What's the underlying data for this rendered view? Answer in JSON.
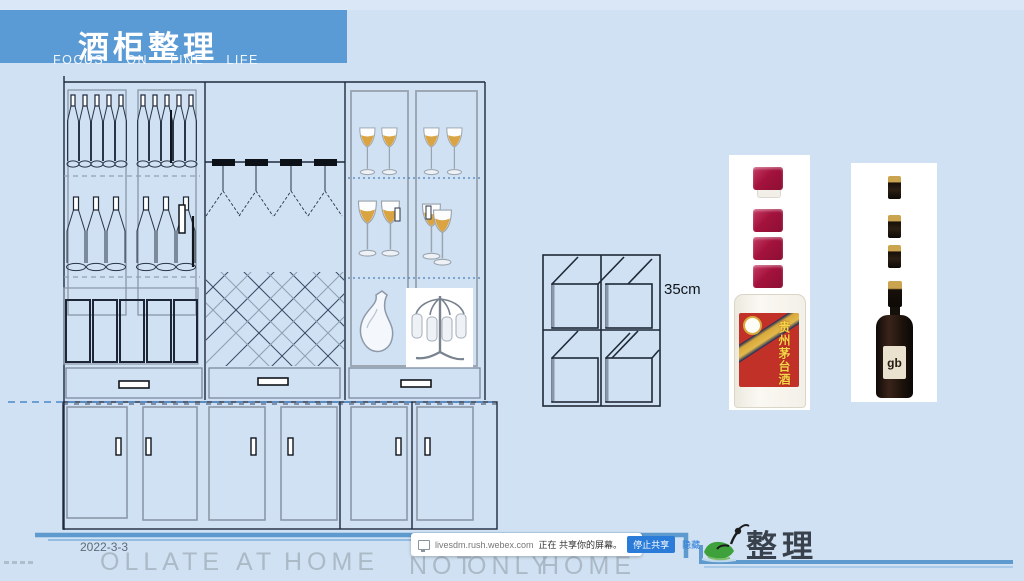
{
  "header": {
    "title": "酒柜整理",
    "subtitle": "FOCUS ON FINE LIFE",
    "banner_color": "#5b9bd5"
  },
  "diagram": {
    "dimension_label": "35cm"
  },
  "products": {
    "moutai": {
      "label_text": "贵州茅台酒",
      "cap_color": "#a3123d"
    },
    "dark_wine": {
      "label_text": "gb"
    }
  },
  "notification": {
    "source": "livesdm.rush.webex.com",
    "message": "正在 共享你的屏幕。",
    "stop_button": "停止共享",
    "hide_button": "隐藏",
    "accent_color": "#2b7cd8"
  },
  "footer": {
    "date": "2022-3-3",
    "watermark_left": [
      "OLLATE",
      "AT",
      "HOME"
    ],
    "watermark_right": [
      "NOT",
      "ONLY",
      "HOME"
    ],
    "logo_text": "整理"
  }
}
